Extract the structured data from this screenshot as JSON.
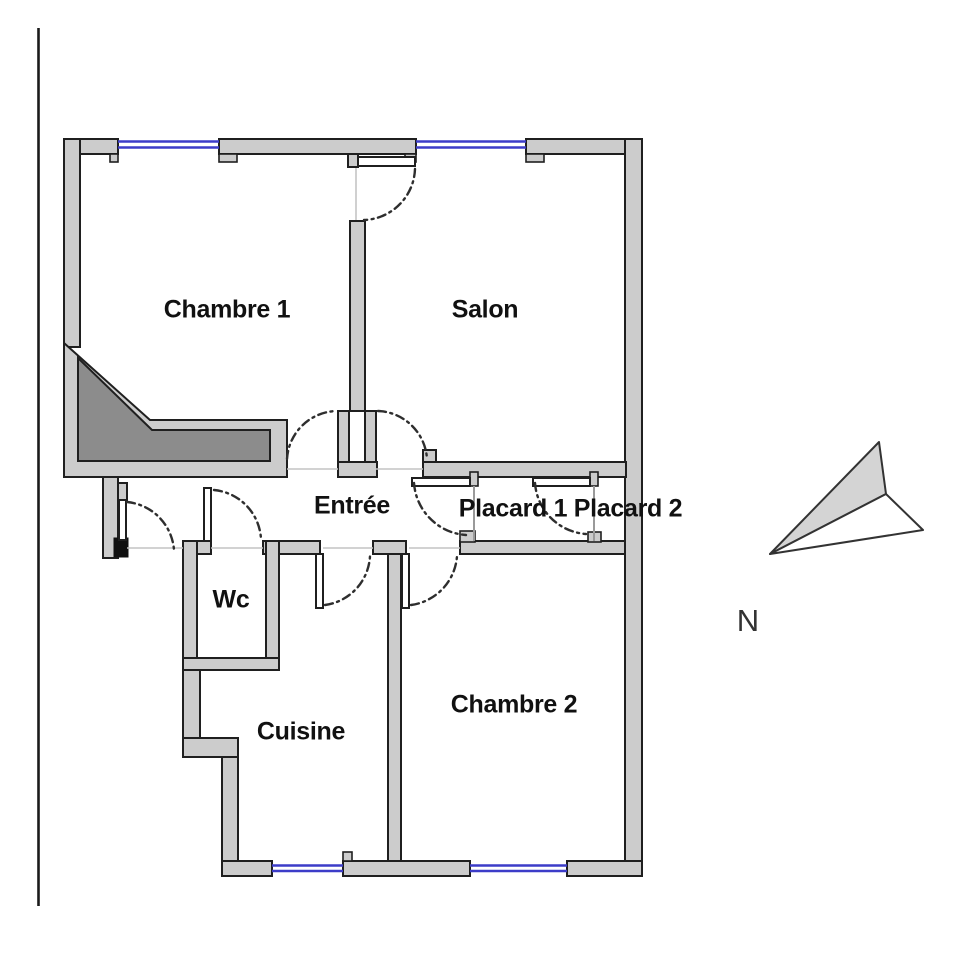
{
  "title": "Apartment floor plan",
  "rooms": {
    "chambre1": "Chambre 1",
    "salon": "Salon",
    "entree": "Entrée",
    "placard1": "Placard 1",
    "placard2": "Placard 2",
    "wc": "Wc",
    "cuisine": "Cuisine",
    "chambre2": "Chambre 2"
  },
  "compass": {
    "north": "N"
  },
  "colors": {
    "wall-fill": "#cccccc",
    "wall-line": "#1f1f1f",
    "dark-fill": "#8c8c8c",
    "window": "#3c3cc8",
    "arc": "#2e2e2e",
    "faint": "#c4c4c4",
    "faint2": "#9a9a9a",
    "north-fill": "#d4d4d4",
    "label": "#111111",
    "edge": "#1a1a1a"
  }
}
